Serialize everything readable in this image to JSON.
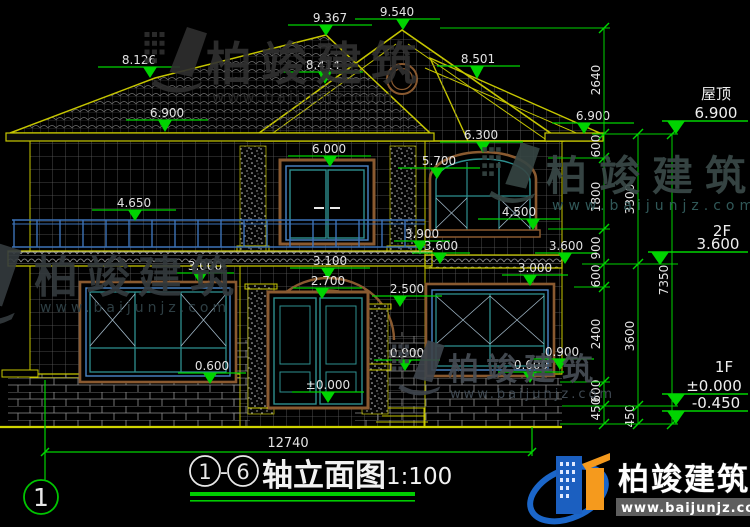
{
  "drawing": {
    "type": "architectural elevation (CAD)",
    "scale_label": "1:100",
    "title_text": "轴立面图",
    "axis_start": "1",
    "axis_end": "6",
    "axis_bubble": "1",
    "total_width_dim": "12740"
  },
  "right_levels": {
    "roof_name": "屋顶",
    "roof_value": "6.900",
    "f2_name": "2F",
    "f2_value": "3.600",
    "f1_name": "1F",
    "f1_value": "±0.000",
    "grade_value": "-0.450"
  },
  "markers": [
    {
      "v": "9.367",
      "ax": 326,
      "ay": 36,
      "lx1": 288,
      "lx2": 372,
      "ly": 25,
      "tx": 330
    },
    {
      "v": "9.540",
      "ax": 403,
      "ay": 30,
      "lx1": 355,
      "lx2": 440,
      "ly": 19,
      "tx": 397
    },
    {
      "v": "8.501",
      "ax": 477,
      "ay": 79,
      "lx1": 437,
      "lx2": 520,
      "ly": 66,
      "tx": 478
    },
    {
      "v": "8.126",
      "ax": 150,
      "ay": 78,
      "lx1": 98,
      "lx2": 180,
      "ly": 67,
      "tx": 139
    },
    {
      "v": "8.414",
      "ax": 325,
      "ay": 84,
      "lx1": 283,
      "lx2": 363,
      "ly": 72,
      "tx": 323
    },
    {
      "v": "6.900",
      "ax": 165,
      "ay": 132,
      "lx1": 126,
      "lx2": 208,
      "ly": 120,
      "tx": 167
    },
    {
      "v": "6.900",
      "ax": 584,
      "ay": 134,
      "lx1": 552,
      "lx2": 634,
      "ly": 123,
      "tx": 593
    },
    {
      "v": "6.300",
      "ax": 483,
      "ay": 153,
      "lx1": 440,
      "lx2": 523,
      "ly": 142,
      "tx": 481
    },
    {
      "v": "6.000",
      "ax": 330,
      "ay": 167,
      "lx1": 288,
      "lx2": 371,
      "ly": 156,
      "tx": 329
    },
    {
      "v": "5.700",
      "ax": 437,
      "ay": 179,
      "lx1": 398,
      "lx2": 480,
      "ly": 168,
      "tx": 439
    },
    {
      "v": "4.650",
      "ax": 135,
      "ay": 221,
      "lx1": 92,
      "lx2": 176,
      "ly": 210,
      "tx": 134
    },
    {
      "v": "4.500",
      "ax": 533,
      "ay": 230,
      "lx1": 478,
      "lx2": 560,
      "ly": 219,
      "tx": 519
    },
    {
      "v": "3.900",
      "ax": 420,
      "ay": 252,
      "lx1": 394,
      "lx2": 450,
      "ly": 241,
      "tx": 422
    },
    {
      "v": "3.600",
      "ax": 440,
      "ay": 264,
      "lx1": 412,
      "lx2": 470,
      "ly": 253,
      "tx": 441
    },
    {
      "v": "3.600",
      "ax": 565,
      "ay": 264,
      "lx1": 535,
      "lx2": 597,
      "ly": 253,
      "tx": 566
    },
    {
      "v": "3.000",
      "ax": 200,
      "ay": 284,
      "lx1": 176,
      "lx2": 234,
      "ly": 273,
      "tx": 205
    },
    {
      "v": "3.100",
      "ax": 328,
      "ay": 279,
      "lx1": 290,
      "lx2": 370,
      "ly": 268,
      "tx": 330
    },
    {
      "v": "2.700",
      "ax": 322,
      "ay": 299,
      "lx1": 293,
      "lx2": 362,
      "ly": 288,
      "tx": 328
    },
    {
      "v": "2.500",
      "ax": 400,
      "ay": 307,
      "lx1": 372,
      "lx2": 442,
      "ly": 296,
      "tx": 407
    },
    {
      "v": "3.000",
      "ax": 530,
      "ay": 286,
      "lx1": 502,
      "lx2": 568,
      "ly": 275,
      "tx": 535
    },
    {
      "v": "0.900",
      "ax": 405,
      "ay": 371,
      "lx1": 374,
      "lx2": 440,
      "ly": 360,
      "tx": 407
    },
    {
      "v": "0.900",
      "ax": 560,
      "ay": 370,
      "lx1": 530,
      "lx2": 594,
      "ly": 359,
      "tx": 562
    },
    {
      "v": "0.600",
      "ax": 210,
      "ay": 384,
      "lx1": 178,
      "lx2": 246,
      "ly": 373,
      "tx": 212
    },
    {
      "v": "0.600",
      "ax": 530,
      "ay": 383,
      "lx1": 498,
      "lx2": 564,
      "ly": 372,
      "tx": 531
    },
    {
      "v": "±0.000",
      "ax": 328,
      "ay": 403,
      "lx1": 292,
      "lx2": 364,
      "ly": 392,
      "tx": 328
    },
    {
      "v": "6.900",
      "ax": 676,
      "ay": 134,
      "lx1": 662,
      "lx2": 748,
      "ly": 121,
      "tx": 716,
      "big": true
    },
    {
      "v": "3.600",
      "ax": 660,
      "ay": 265,
      "lx1": 648,
      "lx2": 748,
      "ly": 252,
      "tx": 718,
      "big": true
    },
    {
      "v": "±0.000",
      "ax": 676,
      "ay": 406,
      "lx1": 662,
      "lx2": 748,
      "ly": 394,
      "tx": 714,
      "big": true
    },
    {
      "v": "-0.450",
      "ax": 676,
      "ay": 424,
      "lx1": 662,
      "lx2": 748,
      "ly": 411,
      "tx": 716,
      "big": true
    }
  ],
  "chain_dims": [
    {
      "v": "2640",
      "x": 604,
      "y": 80
    },
    {
      "v": "600",
      "x": 604,
      "y": 146
    },
    {
      "v": "1800",
      "x": 604,
      "y": 197
    },
    {
      "v": "900",
      "x": 604,
      "y": 248
    },
    {
      "v": "600",
      "x": 604,
      "y": 276
    },
    {
      "v": "2400",
      "x": 604,
      "y": 334
    },
    {
      "v": "600",
      "x": 604,
      "y": 391
    },
    {
      "v": "450",
      "x": 604,
      "y": 409
    },
    {
      "v": "3300",
      "x": 638,
      "y": 199
    },
    {
      "v": "3600",
      "x": 638,
      "y": 336
    },
    {
      "v": "450",
      "x": 638,
      "y": 416
    },
    {
      "v": "7350",
      "x": 672,
      "y": 280
    }
  ],
  "watermark": {
    "brand": "柏竣建筑",
    "url": "www.baijunjz.com"
  },
  "colors": {
    "dim_green": "#00d400",
    "line_yellow": "#c6c600",
    "frame_teal": "#2e8f8f",
    "frame_blue": "#4a86c8",
    "surround_brown": "#8a5a30",
    "logo_blue": "#1b5fc0",
    "logo_orange": "#f59a1d"
  }
}
